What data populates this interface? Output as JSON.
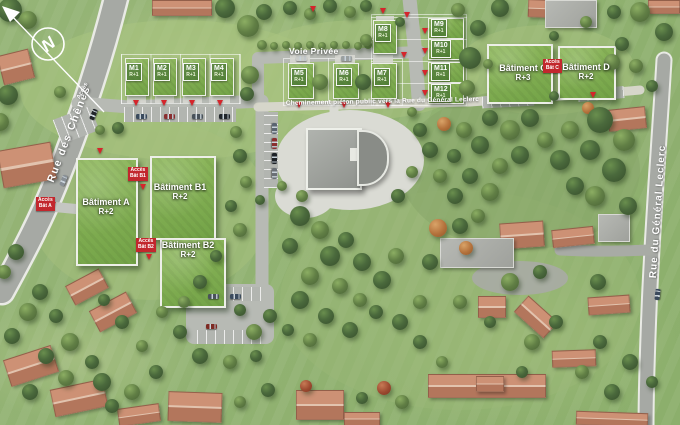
{
  "plan": {
    "compass_label": "N",
    "streets": {
      "rue_des_chenes": "Rue des Chênes",
      "rue_du_general_leclerc": "Rue du Général Leclerc",
      "voie_privee": "Voie Privée",
      "cheminement_pieton": "Cheminement piéton public vers la Rue du Général Leclerc",
      "acces_entry": "Accès"
    },
    "lots": [
      {
        "name": "M1",
        "floors": "R+1"
      },
      {
        "name": "M2",
        "floors": "R+1"
      },
      {
        "name": "M3",
        "floors": "R+1"
      },
      {
        "name": "M4",
        "floors": "R+1"
      },
      {
        "name": "M5",
        "floors": "R+1"
      },
      {
        "name": "M6",
        "floors": "R+1"
      },
      {
        "name": "M7",
        "floors": "R+1"
      },
      {
        "name": "M8",
        "floors": "R+1"
      },
      {
        "name": "M9",
        "floors": "R+1"
      },
      {
        "name": "M10",
        "floors": "R+1"
      },
      {
        "name": "M11",
        "floors": "R+1"
      },
      {
        "name": "M12",
        "floors": "R+1"
      }
    ],
    "buildings": [
      {
        "name": "Bâtiment A",
        "floors": "R+2"
      },
      {
        "name": "Bâtiment B1",
        "floors": "R+2"
      },
      {
        "name": "Bâtiment B2",
        "floors": "R+2"
      },
      {
        "name": "Bâtiment C",
        "floors": "R+3"
      },
      {
        "name": "Bâtiment D",
        "floors": "R+2"
      }
    ],
    "access_labels": [
      {
        "line1": "Accès",
        "line2": "Bât A"
      },
      {
        "line1": "Accès",
        "line2": "Bât B1"
      },
      {
        "line1": "Accès",
        "line2": "Bât B2"
      },
      {
        "line1": "Accès",
        "line2": "Bât C"
      }
    ],
    "colors": {
      "green_roof": "#7fae4e",
      "grass": "#94b173",
      "road": "#a6a9a4",
      "path": "#d6d6ca",
      "terracotta_roof": "#c4846a",
      "access_red": "#c2272d",
      "label_white": "#ffffff"
    }
  }
}
